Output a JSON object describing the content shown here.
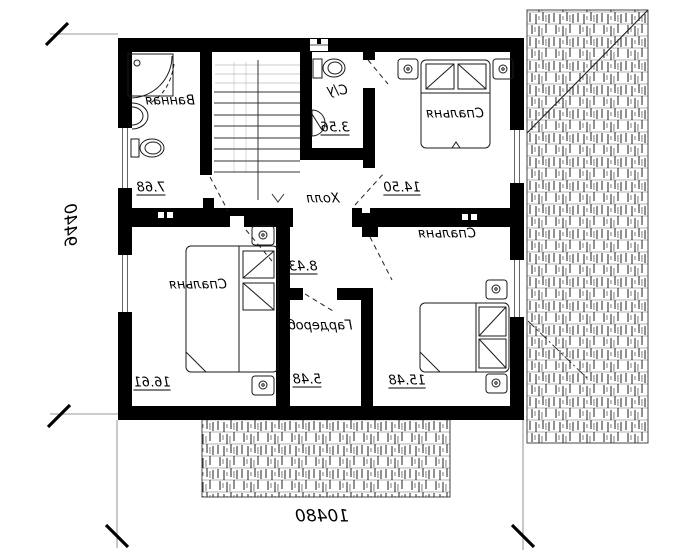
{
  "rooms": {
    "bathroom": {
      "name": "Ванная",
      "area": "7.68"
    },
    "wc": {
      "name": "С/у",
      "area": "3.56"
    },
    "bedroom_top": {
      "name": "Спальня",
      "area": "14.50"
    },
    "hall": {
      "name": "Холл",
      "area": "8.43"
    },
    "bedroom_left": {
      "name": "Спальня",
      "area": "16.61"
    },
    "wardrobe": {
      "name": "Гардероб",
      "area": "5.48"
    },
    "bedroom_right": {
      "name": "Спальня",
      "area": "15.48"
    }
  },
  "dimensions": {
    "vertical": "9440",
    "horizontal": "10480"
  },
  "colors": {
    "wall": "#000000",
    "line": "#1a1a1a"
  }
}
